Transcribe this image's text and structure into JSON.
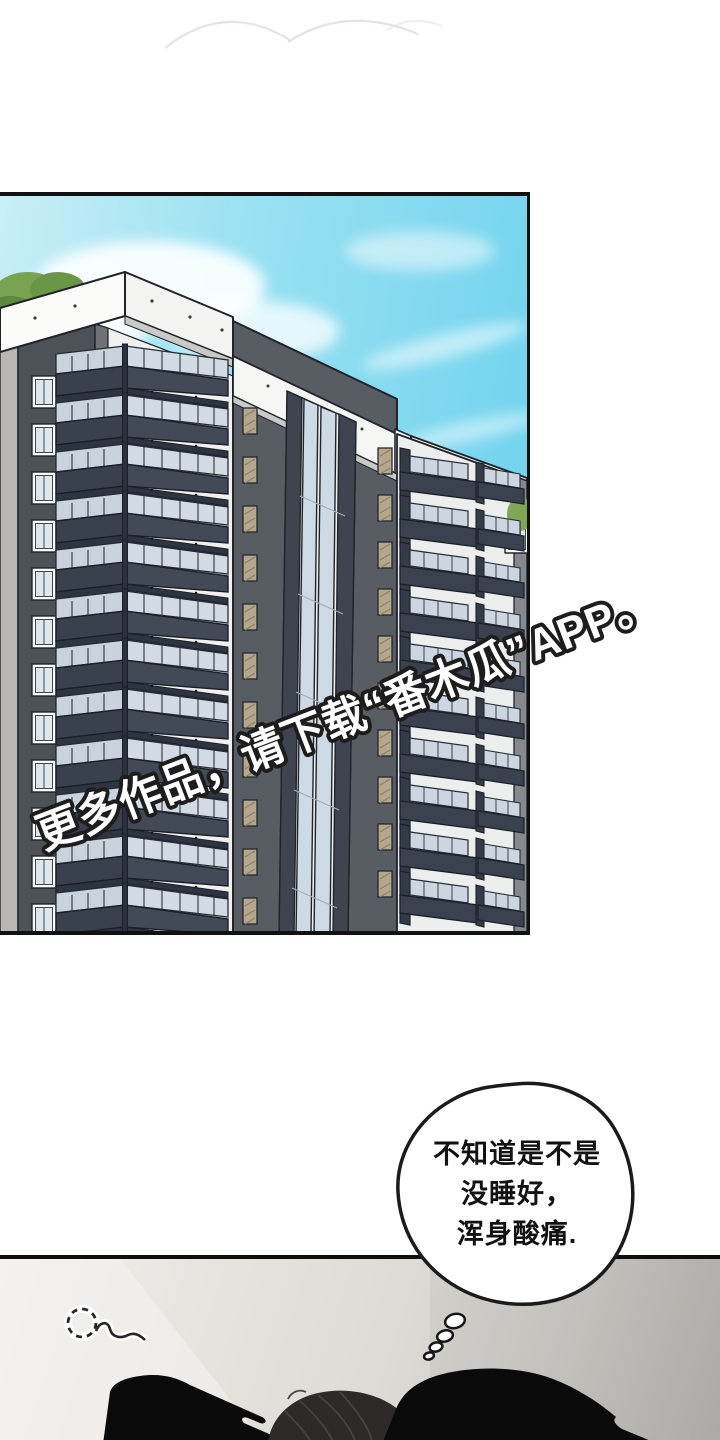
{
  "comic": {
    "watermark": {
      "text": "更多作品，请下载“番木瓜”APP。",
      "fill": "#ffffff",
      "stroke": "#1d1d1d"
    },
    "thought_bubble": {
      "line1": "不知道是不是",
      "line2": "没睡好，",
      "line3": "浑身酸痛.",
      "fill": "#ffffff",
      "stroke": "#1b1b1b"
    },
    "colors": {
      "sky_light": "#c9eef6",
      "sky_main": "#7ed7ee",
      "parapet_white": "#f5f5f4",
      "wall_dark": "#4d5158",
      "tower_gray": "#585c63",
      "balcony_navy": "#39404e",
      "glass_blue": "#d2dbe3",
      "window_tan": "#b5a78c",
      "panel2_bg": "#ddd9d5",
      "figure_black": "#0b0b0b",
      "hair_dark": "#2d2a28",
      "outline": "#1d1d1d"
    },
    "icons": {
      "sleep_doodle": "dashed-circle-with-squiggle",
      "thought_trail": "shrinking-bubbles",
      "cloud_doodle": "faint-arc-lines"
    }
  }
}
